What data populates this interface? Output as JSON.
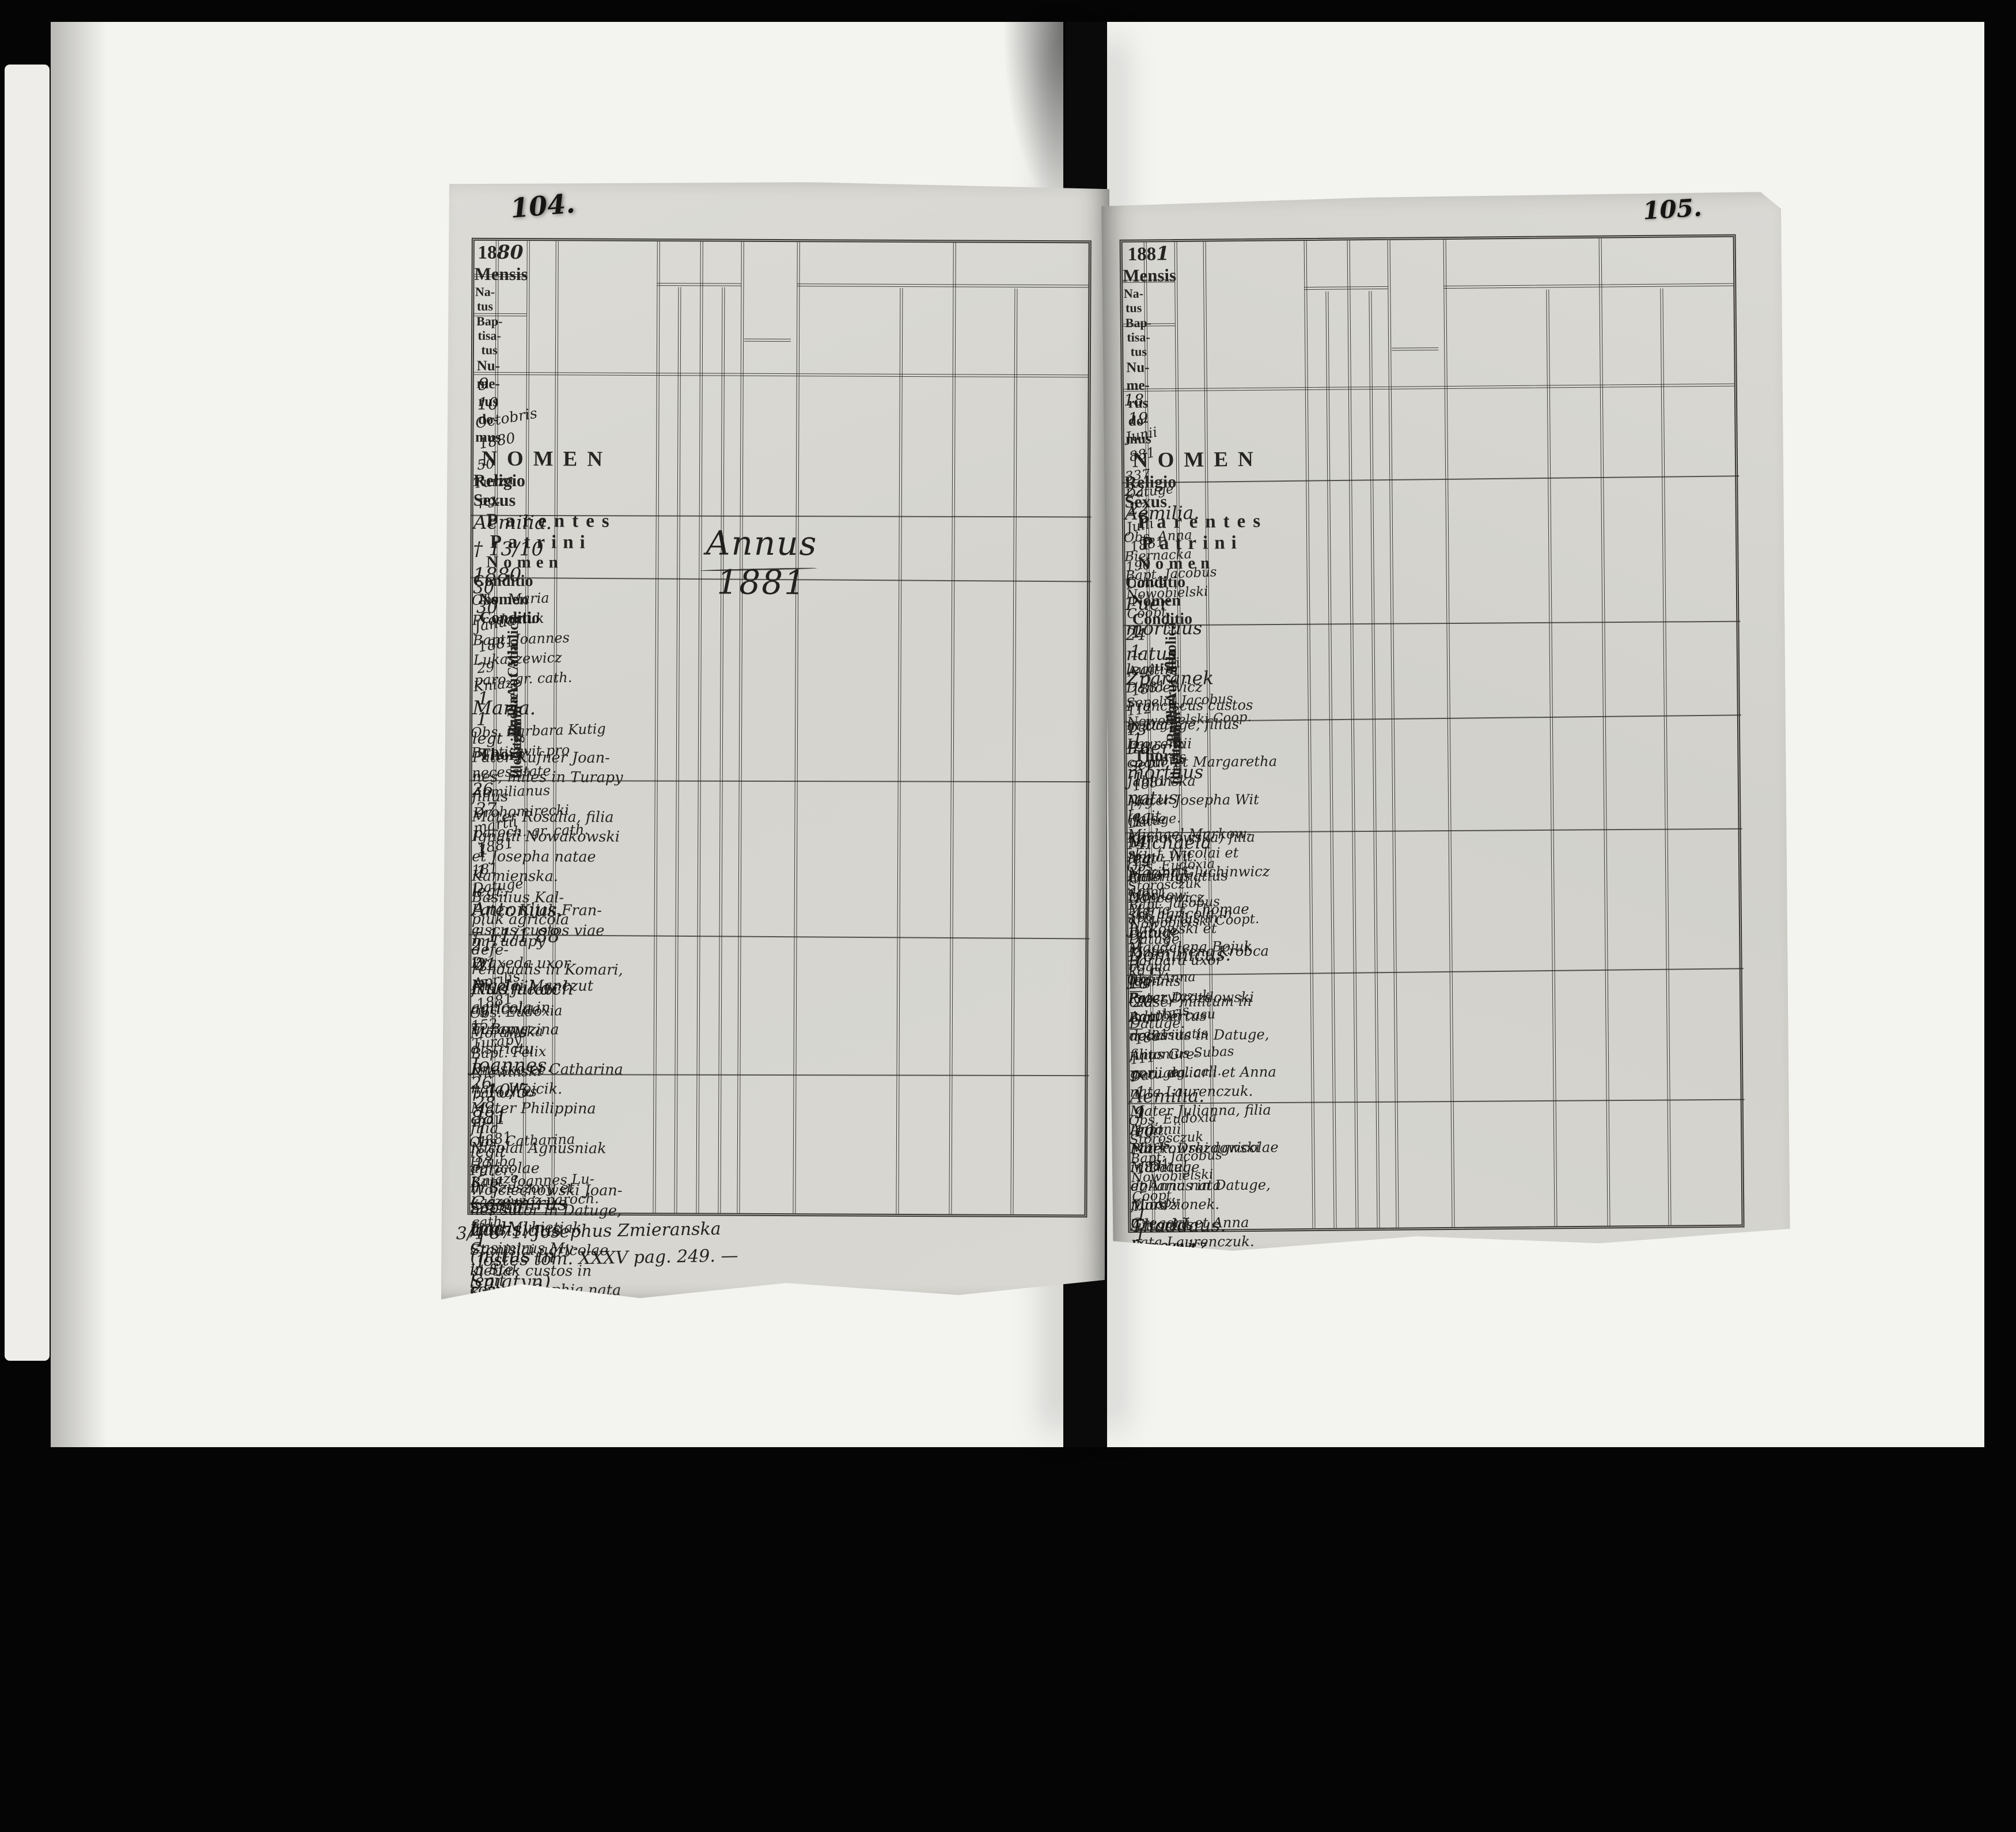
{
  "header": {
    "mensis": "Mensis",
    "natus_lines": [
      "Na-",
      "tus"
    ],
    "baptisatus_lines": [
      "Bap-",
      "tisa-",
      "tus"
    ],
    "numerus_domus_lines": [
      "Nu-",
      "me-",
      "rus",
      "do-",
      "mus"
    ],
    "nomen": "NOMEN",
    "religio": "Religio",
    "catholica": "Catholica",
    "aut_alia": "Aut Alia",
    "sexus": "Sexus",
    "puer": "Puer",
    "puella": "Puella",
    "legitimi": "Legitimi",
    "illegitimi": "Illegitimi",
    "thori": "Thori",
    "parentes": "Parentes",
    "patrini": "Patrini",
    "nomen_sub": "Nomen",
    "conditio": "Conditio"
  },
  "pages": [
    {
      "id": "left",
      "page_number": "104.",
      "year": {
        "printed": "18",
        "written": "80"
      },
      "annus": "Annus 1881",
      "footnote": [
        "3/4 871. Josephus Zmieranska",
        "ostes tom. XXXV pag. 249. —"
      ],
      "rows": [
        {
          "natus": "9",
          "bapt": "10",
          "date": [
            "Octobris",
            "1880"
          ],
          "domus": [
            "50",
            "Turza",
            "pg."
          ],
          "name": [
            "Aemilia.",
            "† 13/10 1880"
          ],
          "struck": -1,
          "clergy": [
            "Obs. Maria Prodaniuk",
            "Bapt. Joannes Lukaszewicz",
            "paro. gr. cath."
          ],
          "cath": "1",
          "sex": "puella",
          "mark": "1",
          "thori": "legt",
          "parentes": [
            "Pater Kufner Joan-",
            "nes, miles in Turapy",
            "filius",
            "Mater Rosalia, filia",
            "Ignatii Nowakowski",
            "et Josepha natae",
            "Kamienska."
          ],
          "patrini": [
            "Basilius Kal-",
            "piuk agricola",
            "in Tudapy",
            "Praxeda uxor",
            "Nicolai Manczut",
            "agricola in",
            "Turapy"
          ]
        },
        {
          "natus": "30",
          "bapt": "30",
          "date": [
            "Januarii",
            "1881"
          ],
          "domus": [
            "29",
            "Kniaze"
          ],
          "name": [
            "Maria."
          ],
          "struck": -1,
          "clergy": [
            "Obs. Barbara Kutig",
            "Baptisavit pro necessitate",
            "Aemilianus Drohomirecki",
            "paroch. gr. cath."
          ],
          "cath": "1",
          "sex": "puella",
          "mark": "1",
          "thori": "legt.",
          "parentes": [
            "Pater. Kijak Fran-",
            "ciscus custos viae defe-",
            "rendualis in Komari,",
            "filius Jacobi agricolae",
            "in Bongzina districtu",
            "Bnesko et Catharina nata Wojcik.",
            "Mater Philippina filia",
            "Nicolai Agnusniak agricolae",
            "in Szeszory et Sophia",
            "nata Mykietiak"
          ],
          "patrini": [
            "Casimirus My-",
            "kietiak custos in",
            "Kniaze et",
            "Maria uxor",
            "Basilii Anu-",
            "niak."
          ],
          "note": "Cap. Katleriank"
        },
        {
          "natus": "26",
          "bapt": "27",
          "date": [
            "martii",
            "1881"
          ],
          "domus": [
            "181",
            "Datuge"
          ],
          "name": [
            "Antonius.",
            "† 11/1 88",
            "w Rudnikach"
          ],
          "struck": -1,
          "clergy": [
            "Obs. Eudoxia Morawska",
            "Bapt. Felix Niewinski",
            "parochus"
          ],
          "cath": "1",
          "sex": "puer",
          "mark": "1",
          "thori": "legit",
          "parentes": [
            "Pater: Wojciechowski Joan-",
            "nes sutor in Datuge, filius",
            "Stanislai agricolae in Ste-",
            "cowa et Sophia nata Gonbarrenska.",
            "Mater: Theresia Kopf, filia",
            "Joannis Kopf custos in",
            "Wiener Neustadt in Austria",
            "et Constantia Menfrilla"
          ],
          "patrini": [
            "Gregorius Suchocko",
            "custos in Datuge",
            "Maria uxor Micha-",
            "elis Markowski",
            "agricola in Datuge."
          ]
        },
        {
          "natus": "21",
          "bapt": "21",
          "date": [
            "Aprilis",
            "1881"
          ],
          "domus": [
            "152",
            "Turapy"
          ],
          "name": [
            "Joannes.",
            "† 10/5 881"
          ],
          "struck": -1,
          "clergy": [
            "Obs. Catharina Hauba",
            "Bapt. Joannes Lu-",
            "kaszewicz paroch. cath."
          ],
          "cath": "1",
          "sex": "puer",
          "mark": "1",
          "thori": "legit",
          "parentes": [
            "Pater: Kolano Nicolaus",
            "sutor in Turapy, filius Ada-",
            "mi sutoris et Anna nata",
            "Maruskiewicz.",
            "Mater: Thecla, filia Andreae",
            "Ondrowicz agricolae et",
            "Antonia nata Skulska."
          ],
          "patrini": [
            "Joannes Kolano",
            "sutor in",
            "Popielniki",
            "Catharina uxor",
            "Josephi Hauba",
            "in Popielniki."
          ]
        },
        {
          "natus": "26",
          "bapt": "28",
          "date": [
            "maji",
            "1881"
          ],
          "domus": [
            "23",
            "Kniaze"
          ],
          "name": [
            "Casimirus",
            "Ladislaus",
            "(natus in Sniatyn)"
          ],
          "struck": 0,
          "clergy": [
            "Obs. Agnes Matkuluk",
            "Bapt. Felix Niewinski",
            "prech."
          ],
          "cath": "1",
          "sex": "puer",
          "mark": "1",
          "thori": "legt.",
          "parentes": [
            "Mykietiuk Casimirus",
            "cust. in Kniaze filius",
            "Agnetis Mykietiuk.",
            "Mater Thecla, filia Mathiae",
            "Szymanski et civium",
            "artis et Matild nata",
            "Kluska."
          ],
          "patrini": [
            "Demetrius Zatko",
            "noverca vita cognata",
            "in Kniaze",
            "Barbara Glaser",
            "uxor Joannis nota-",
            "rii in Datuge."
          ]
        }
      ]
    },
    {
      "id": "right",
      "page_number": "105.",
      "year": {
        "printed": "188",
        "written": "1"
      },
      "annus": "",
      "footnote": [],
      "rows": [
        {
          "natus": "18",
          "bapt": "19",
          "date": [
            "Junii",
            "881"
          ],
          "domus": [
            "337",
            "Datuge"
          ],
          "name": [
            "Aemilia."
          ],
          "struck": -1,
          "clergy": [
            "Obs. Anna Biernacka",
            "Bapt. Jacobus Nowobielski",
            "Coopt."
          ],
          "cath": "1",
          "sex": "puella",
          "mark": "1",
          "thori": "legitim",
          "parentes": [
            "Dancewicz Franciscus custos",
            "in Datuge, filius Laurentii",
            "coqui, et Margaretha Jablonska",
            "Mater Josepha Wit (false",
            "Komorowska) filia Anna Wit."
          ],
          "patrini": [
            "Antonius Dancewicz",
            "arcularius in Datuge",
            "Barbara uxor Joannis",
            "Glaser militum in",
            "Datuge."
          ]
        },
        {
          "natus": "22",
          "bapt": "22",
          "date": [
            "Julii",
            "1881"
          ],
          "domus": [
            "190",
            "Datug"
          ],
          "name": [
            "Puer mortuus",
            "natus",
            "Zparanek"
          ],
          "struck": -1,
          "clergy": [
            "Sepeliit Jacobus",
            "Nowobielski Coop."
          ],
          "cath": "1 „",
          "sex": "puer",
          "mark": "1 „",
          "thori": "legit.",
          "parentes": [
            "Michael Markow-",
            "ski, f. Nicolai et",
            "Marina Gluchinwicz agr.",
            "Maria, f. Thomae",
            "Jurkowski et",
            "Magdalena Bojuk",
            "coqua"
          ],
          "patrini": [
            "—",
            "",
            "—",
            "",
            "—"
          ]
        },
        {
          "natus": "24",
          "bapt": "-",
          "date": [
            "Augusti",
            "1881"
          ],
          "domus": [
            "112",
            "Datug"
          ],
          "name": [
            "Puer mortuus",
            "natus"
          ],
          "struck": -1,
          "clergy": [],
          "cath": "1",
          "sex": "puer",
          "mark": "1",
          "thori": "legt",
          "parentes": [
            "Pater Ignatius Markow-",
            "ski, agricola in Datuge",
            "Mater Irena Krobca",
            "ka ry"
          ],
          "patrini": [
            "—",
            "",
            "—"
          ]
        },
        {
          "natus": "13",
          "bapt": "18",
          "date": [
            "Septbris",
            "1881"
          ],
          "domus": [
            "179",
            "Datuge."
          ],
          "name": [
            "Michaëla"
          ],
          "struck": -1,
          "clergy": [
            "Obs. Eudoxia Storosczuk",
            "Bapt. Jacobus",
            "Nowobielski Coopt."
          ],
          "cath": "1",
          "sex": "puella",
          "mark": "1",
          "thori": "legit",
          "parentes": [
            "Pater Drozdowski Adalbertus",
            "doliarius in Datuge, filius Gre-",
            "gorii doliarii et Anna nata Laurenczuk.",
            "Mater Julianna, filia Antonii",
            "Markowski agricolae in Datuge",
            "et Anna nata Mordzionek."
          ],
          "patrini": [
            "Antonius Dancewicz",
            "faber lignarius in Datuge",
            "Agnes uxor Micha-",
            "elis Grzegorzki",
            "et Smitye"
          ]
        },
        {
          "natus": "14",
          "bapt": "14",
          "date": [
            "Octobris",
            "1881"
          ],
          "domus": [
            "106",
            "Datuge"
          ],
          "name": [
            "Dominicus."
          ],
          "struck": -1,
          "clergy": [
            "Obs. Anna Rozczytczuk",
            "Bapt. in casu necessitatis",
            "Antonius Subas",
            "per... ag. call."
          ],
          "cath": "1",
          "sex": "puer",
          "mark": "1",
          "thori": "legit.",
          "parentes": [
            "Pater: Drozdowski Michael",
            "doliarius in Datuge, filius",
            "Gregorii et Anna nata Laurenczuk.",
            "Mater Anna, filia Michaelis",
            "Gregorasiczuk agricolae in",
            "Datuge et Agatha nata",
            "Rybczak agcall."
          ],
          "patrini": [
            "Gabriel Semeciak",
            "agricola in Datuge",
            "Praxeda uxor Basi-",
            "lii Stryhyjczuk",
            "agricola in Datiwa"
          ]
        },
        {
          "natus": "18",
          "bapt": "20",
          "date": [
            "Octobris",
            "1881"
          ],
          "domus": [
            "111",
            "Datuge"
          ],
          "name": [
            "Aemilia."
          ],
          "struck": -1,
          "clergy": [
            "Obs. Eudoxia Storosczuk",
            "Bapt: Jacobus Nowobielski",
            "Coopt."
          ],
          "cath": "1",
          "sex": "puella",
          "mark": "1",
          "thori": "legitim",
          "parentes": [
            "Pater: Markowski Petrus",
            "agricola in Datuge, filius",
            "Joannis agricolae et Sophia",
            "nata Wolosczuk.",
            "Mater Maria, filia Demetrii",
            "Ceholnik murarii in Wasilkowa",
            "et Catharina nata Pokorna."
          ],
          "patrini": [
            "Nicolaus Ceholnik",
            "caletor Wanskowa",
            "Maria uxor Michae-",
            "lis Markowski agr.",
            "in Datuge."
          ]
        },
        {
          "natus": "9",
          "bapt": "10",
          "date": [
            "Nbris",
            "1881"
          ],
          "domus": [
            "2",
            "Turapy"
          ],
          "name": [
            "Thaddaus.",
            "† 28/11 881"
          ],
          "struck": -1,
          "clergy": [
            "Obs: Maria Prodaniuk",
            "Bapt Franco Lukaszewicz",
            "paro. gr. cath."
          ],
          "cath": "1",
          "sex": "puer",
          "mark": "1",
          "thori": "legt.",
          "parentes": [
            "Pater: Andronis Nicolaus",
            "cantor ecclesiasticus in Turapy",
            "filius Thaddaei organi et",
            "Katarina Kulik.",
            "Mater: Malvina filia Vincentii",
            "Rosian et Joanna Rostaba",
            "civium in Zamosci in Rastowia."
          ],
          "patrini": [
            "Gregorius Aywas",
            "conductor bonorum",
            "Turapy et",
            "Paulina Lukasiewicz",
            "paro. gr. cath."
          ]
        }
      ]
    }
  ]
}
